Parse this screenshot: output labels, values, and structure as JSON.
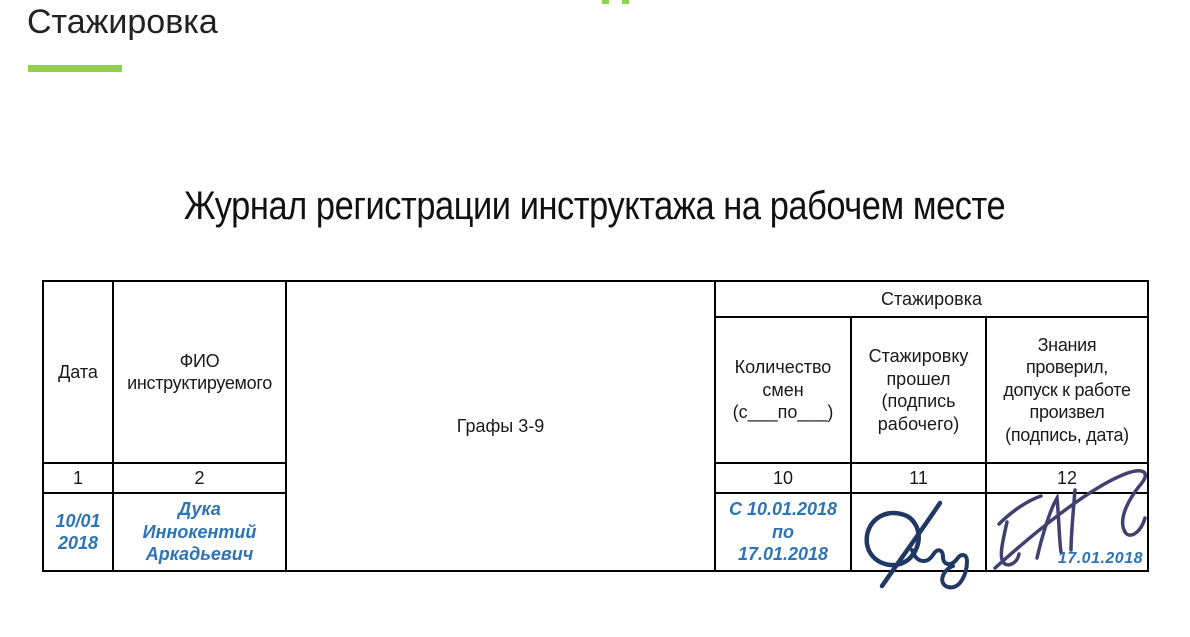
{
  "page": {
    "title": "Стажировка",
    "heading": "Журнал регистрации инструктажа на рабочем месте"
  },
  "colors": {
    "accent_green": "#92d050",
    "handwriting_blue": "#2e74b5",
    "worker_signature_navy": "#1f3864",
    "approver_signature_indigo": "#42406e",
    "table_border": "#000000"
  },
  "decorations": {
    "top_cut_text_marks": "two green fragments of cropped text at top edge"
  },
  "table": {
    "group_header": "Стажировка",
    "headers": {
      "date": "Дата",
      "name": "ФИО\nинструктируемого",
      "grafy": "Графы 3-9",
      "shifts": "Количество\nсмен\n(с___по___)",
      "passed": "Стажировку\nпрошел\n(подпись\nрабочего)",
      "checked": "Знания\nпроверил,\nдопуск  к работе\nпроизвел\n(подпись, дата)"
    },
    "numbers": {
      "date": "1",
      "name": "2",
      "shifts": "10",
      "passed": "11",
      "checked": "12"
    },
    "entry": {
      "date": "10/01\n2018",
      "name": "Дука\nИннокентий\nАркадьевич",
      "shifts": "С 10.01.2018\nпо\n17.01.2018",
      "passed_signature_icon": "worker-signature",
      "checked_signature_icon": "approver-signature",
      "checked_date": "17.01.2018"
    }
  }
}
